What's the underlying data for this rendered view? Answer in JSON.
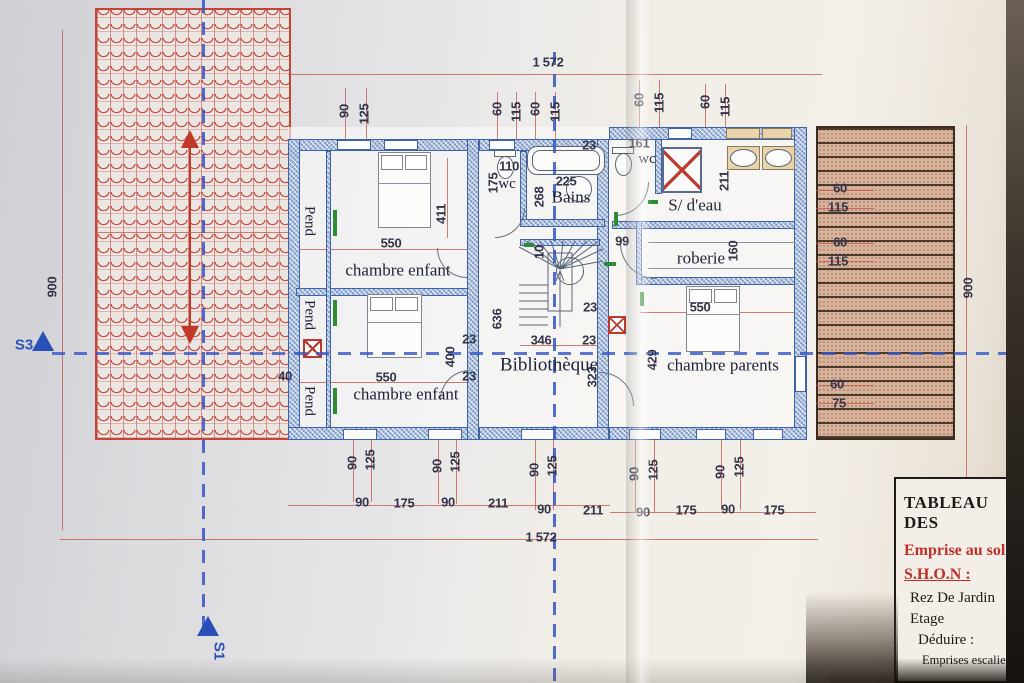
{
  "colors": {
    "wall_blue": "#4468b0",
    "dimension_red": "#c4574e",
    "roof_red": "#c2453a",
    "terrace_brown": "#d9b29c",
    "axis_blue": "#3356c8",
    "marker_blue": "#2a50b8",
    "table_red": "#c03028"
  },
  "plan": {
    "room_labels": [
      {
        "t": "chambre enfant",
        "x": 398,
        "y": 271,
        "c": "room",
        "n": "room-label-chambre-enfant-1"
      },
      {
        "t": "chambre enfant",
        "x": 406,
        "y": 395,
        "c": "room",
        "n": "room-label-chambre-enfant-2"
      },
      {
        "t": "Bibliothèque",
        "x": 549,
        "y": 366,
        "c": "room lg",
        "n": "room-label-bibliotheque"
      },
      {
        "t": "chambre parents",
        "x": 723,
        "y": 366,
        "c": "room",
        "n": "room-label-chambre-parents"
      },
      {
        "t": "roberie",
        "x": 701,
        "y": 259,
        "c": "room",
        "n": "room-label-roberie"
      },
      {
        "t": "S/ d'eau",
        "x": 695,
        "y": 206,
        "c": "room",
        "n": "room-label-salle-deau"
      },
      {
        "t": "Bains",
        "x": 571,
        "y": 198,
        "c": "room",
        "n": "room-label-bains"
      },
      {
        "t": "wc",
        "x": 507,
        "y": 184,
        "c": "room sm",
        "n": "room-label-wc-1"
      },
      {
        "t": "wc",
        "x": 647,
        "y": 159,
        "c": "room sm",
        "n": "room-label-wc-2"
      },
      {
        "t": "Pend",
        "x": 309,
        "y": 221,
        "c": "room v90 sm",
        "n": "room-label-pend-1"
      },
      {
        "t": "Pend",
        "x": 309,
        "y": 315,
        "c": "room v90 sm",
        "n": "room-label-pend-2"
      },
      {
        "t": "Pend",
        "x": 309,
        "y": 401,
        "c": "room v90 sm",
        "n": "room-label-pend-3"
      }
    ],
    "dimension_labels": [
      {
        "t": "1 572",
        "x": 548,
        "y": 62,
        "c": "dim"
      },
      {
        "t": "90",
        "x": 344,
        "y": 111,
        "c": "dim v"
      },
      {
        "t": "125",
        "x": 364,
        "y": 114,
        "c": "dim v"
      },
      {
        "t": "60",
        "x": 497,
        "y": 109,
        "c": "dim v"
      },
      {
        "t": "115",
        "x": 516,
        "y": 112,
        "c": "dim v"
      },
      {
        "t": "60",
        "x": 535,
        "y": 109,
        "c": "dim v"
      },
      {
        "t": "115",
        "x": 555,
        "y": 112,
        "c": "dim v"
      },
      {
        "t": "60",
        "x": 639,
        "y": 100,
        "c": "dim v"
      },
      {
        "t": "115",
        "x": 659,
        "y": 103,
        "c": "dim v"
      },
      {
        "t": "60",
        "x": 705,
        "y": 102,
        "c": "dim v"
      },
      {
        "t": "115",
        "x": 725,
        "y": 107,
        "c": "dim v"
      },
      {
        "t": "161",
        "x": 639,
        "y": 143,
        "c": "dim"
      },
      {
        "t": "23",
        "x": 589,
        "y": 145,
        "c": "dim"
      },
      {
        "t": "110",
        "x": 509,
        "y": 166,
        "c": "dim"
      },
      {
        "t": "175",
        "x": 493,
        "y": 183,
        "c": "dim v"
      },
      {
        "t": "225",
        "x": 566,
        "y": 181,
        "c": "dim"
      },
      {
        "t": "268",
        "x": 539,
        "y": 197,
        "c": "dim v"
      },
      {
        "t": "211",
        "x": 724,
        "y": 181,
        "c": "dim v"
      },
      {
        "t": "99",
        "x": 622,
        "y": 241,
        "c": "dim"
      },
      {
        "t": "160",
        "x": 733,
        "y": 251,
        "c": "dim v"
      },
      {
        "t": "550",
        "x": 391,
        "y": 243,
        "c": "dim"
      },
      {
        "t": "411",
        "x": 441,
        "y": 214,
        "c": "dim v"
      },
      {
        "t": "550",
        "x": 386,
        "y": 377,
        "c": "dim"
      },
      {
        "t": "400",
        "x": 450,
        "y": 357,
        "c": "dim v"
      },
      {
        "t": "23",
        "x": 469,
        "y": 339,
        "c": "dim"
      },
      {
        "t": "23",
        "x": 469,
        "y": 376,
        "c": "dim"
      },
      {
        "t": "636",
        "x": 497,
        "y": 319,
        "c": "dim v"
      },
      {
        "t": "40",
        "x": 285,
        "y": 376,
        "c": "dim"
      },
      {
        "t": "10",
        "x": 539,
        "y": 252,
        "c": "dim v"
      },
      {
        "t": "23",
        "x": 590,
        "y": 307,
        "c": "dim"
      },
      {
        "t": "346",
        "x": 541,
        "y": 340,
        "c": "dim"
      },
      {
        "t": "23",
        "x": 589,
        "y": 340,
        "c": "dim"
      },
      {
        "t": "323",
        "x": 592,
        "y": 377,
        "c": "dim v"
      },
      {
        "t": "429",
        "x": 652,
        "y": 360,
        "c": "dim v"
      },
      {
        "t": "550",
        "x": 700,
        "y": 307,
        "c": "dim"
      },
      {
        "t": "60",
        "x": 840,
        "y": 188,
        "c": "dim"
      },
      {
        "t": "115",
        "x": 838,
        "y": 207,
        "c": "dim"
      },
      {
        "t": "60",
        "x": 840,
        "y": 242,
        "c": "dim"
      },
      {
        "t": "115",
        "x": 838,
        "y": 261,
        "c": "dim"
      },
      {
        "t": "60",
        "x": 837,
        "y": 384,
        "c": "dim"
      },
      {
        "t": "75",
        "x": 839,
        "y": 403,
        "c": "dim"
      },
      {
        "t": "900",
        "x": 52,
        "y": 287,
        "c": "dim v"
      },
      {
        "t": "900",
        "x": 968,
        "y": 288,
        "c": "dim v"
      },
      {
        "t": "90",
        "x": 352,
        "y": 463,
        "c": "dim v"
      },
      {
        "t": "125",
        "x": 370,
        "y": 460,
        "c": "dim v"
      },
      {
        "t": "90",
        "x": 437,
        "y": 466,
        "c": "dim v"
      },
      {
        "t": "125",
        "x": 455,
        "y": 462,
        "c": "dim v"
      },
      {
        "t": "90",
        "x": 534,
        "y": 470,
        "c": "dim v"
      },
      {
        "t": "125",
        "x": 552,
        "y": 466,
        "c": "dim v"
      },
      {
        "t": "90",
        "x": 634,
        "y": 474,
        "c": "dim v"
      },
      {
        "t": "125",
        "x": 653,
        "y": 470,
        "c": "dim v"
      },
      {
        "t": "90",
        "x": 720,
        "y": 472,
        "c": "dim v"
      },
      {
        "t": "125",
        "x": 739,
        "y": 467,
        "c": "dim v"
      },
      {
        "t": "90",
        "x": 362,
        "y": 502,
        "c": "dim"
      },
      {
        "t": "175",
        "x": 404,
        "y": 503,
        "c": "dim"
      },
      {
        "t": "90",
        "x": 448,
        "y": 502,
        "c": "dim"
      },
      {
        "t": "211",
        "x": 498,
        "y": 503,
        "c": "dim"
      },
      {
        "t": "90",
        "x": 544,
        "y": 509,
        "c": "dim"
      },
      {
        "t": "211",
        "x": 593,
        "y": 510,
        "c": "dim"
      },
      {
        "t": "90",
        "x": 643,
        "y": 512,
        "c": "dim"
      },
      {
        "t": "175",
        "x": 686,
        "y": 510,
        "c": "dim"
      },
      {
        "t": "90",
        "x": 728,
        "y": 509,
        "c": "dim"
      },
      {
        "t": "175",
        "x": 774,
        "y": 510,
        "c": "dim"
      },
      {
        "t": "1 572",
        "x": 541,
        "y": 537,
        "c": "dim"
      }
    ],
    "section_markers": [
      {
        "t": "S3",
        "x": 24,
        "y": 345,
        "c": "marker",
        "n": "section-marker-s3"
      },
      {
        "t": "S1",
        "x": 219,
        "y": 651,
        "c": "marker v90",
        "n": "section-marker-s1"
      }
    ]
  },
  "table": {
    "title": "TABLEAU DES",
    "emprise": "Emprise au sol",
    "shon": "S.H.O.N :",
    "rows": [
      "Rez De Jardin",
      "Etage",
      "Déduire :",
      "Emprises escaliers"
    ],
    "reste": "Rest"
  }
}
